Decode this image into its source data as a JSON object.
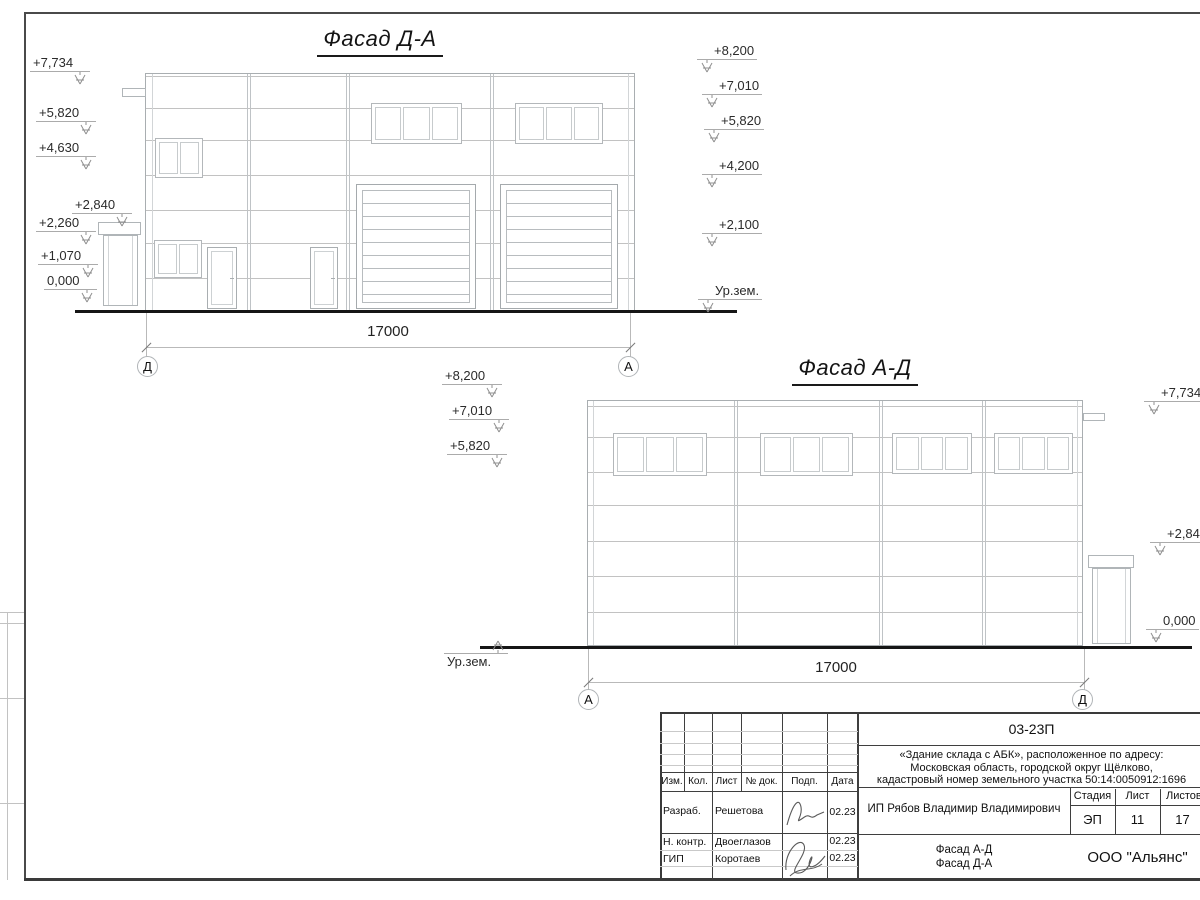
{
  "facade_da": {
    "title": "Фасад Д-А",
    "axis_left": "Д",
    "axis_right": "А",
    "dimension": "17000",
    "ground_label": "Ур.зем.",
    "levels_left": [
      "+7,734",
      "+5,820",
      "+4,630",
      "+2,840",
      "+2,260",
      "+1,070",
      "0,000"
    ],
    "levels_right": [
      "+8,200",
      "+7,010",
      "+5,820",
      "+4,200",
      "+2,100"
    ]
  },
  "facade_ad": {
    "title": "Фасад А-Д",
    "axis_left": "А",
    "axis_right": "Д",
    "dimension": "17000",
    "ground_label": "Ур.зем.",
    "levels_left": [
      "+8,200",
      "+7,010",
      "+5,820"
    ],
    "levels_right": [
      "+7,734",
      "+2,840",
      "0,000"
    ]
  },
  "titleblock": {
    "doc_number": "03-23П",
    "project_lines": [
      "«Здание склада с АБК», расположенное по адресу:",
      "Московская область, городской округ Щёлково,",
      "кадастровый номер земельного участка 50:14:0050912:1696"
    ],
    "client": "ИП Рябов Владимир Владимирович",
    "content_line1": "Фасад А-Д",
    "content_line2": "Фасад Д-А",
    "organization": "ООО \"Альянс\"",
    "col_headers": [
      "Изм.",
      "Кол.",
      "Лист",
      "№ док.",
      "Подп.",
      "Дата"
    ],
    "stage_header": "Стадия",
    "sheet_header": "Лист",
    "total_header": "Листов",
    "stage": "ЭП",
    "sheet_number": "11",
    "sheets_total": "17",
    "rows": [
      {
        "role": "Разраб.",
        "name": "Решетова",
        "date": "02.23"
      },
      {
        "role": "Н. контр.",
        "name": "Двоеглазов",
        "date": "02.23"
      },
      {
        "role": "ГИП",
        "name": "Коротаев",
        "date": "02.23"
      }
    ]
  }
}
